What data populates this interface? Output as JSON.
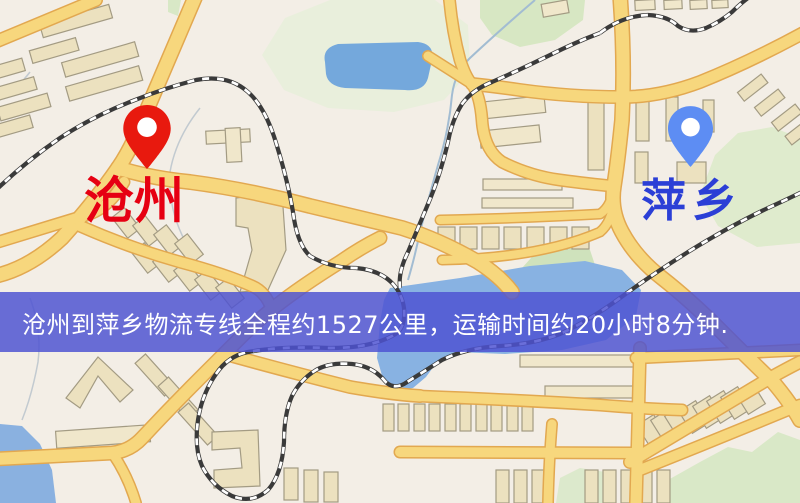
{
  "map": {
    "origin": {
      "name": "沧州",
      "label_color": "#e60012",
      "pin_color": "#e8190e"
    },
    "destination": {
      "name": "萍乡",
      "label_color": "#2b3fd6",
      "pin_color": "#5d8df3"
    },
    "banner": {
      "text": "沧州到萍乡物流专线全程约1527公里，运输时间约20小时8分钟.",
      "bg_color": "#4e52d2",
      "text_color": "#ffffff"
    },
    "route": {
      "distance_km": "1527",
      "duration_hours": "20",
      "duration_minutes": "8"
    },
    "legend_colors": {
      "road": "#f7d77d",
      "railway": "#3a3a3a",
      "water": "#88b2e2",
      "park": "#dfebcd",
      "building": "#ece1bf",
      "background": "#f3eee6"
    }
  }
}
